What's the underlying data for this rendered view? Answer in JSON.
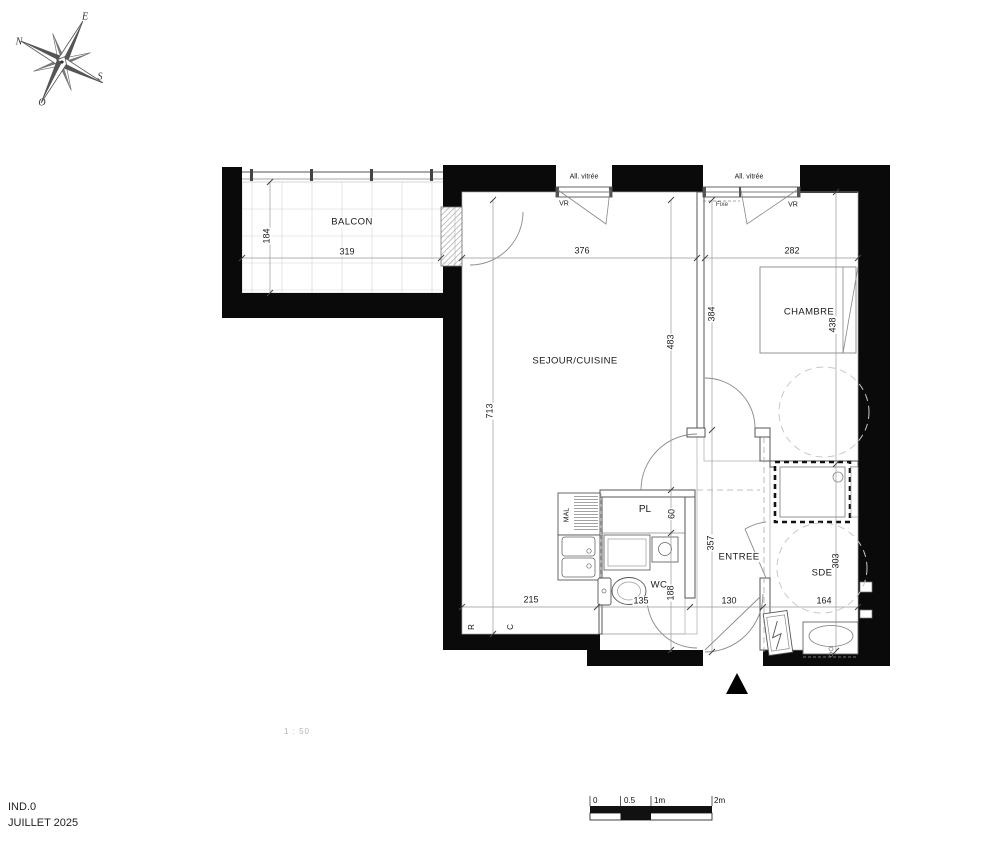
{
  "meta": {
    "revision": "IND.0",
    "date": "JUILLET 2025",
    "scale_note": "1 : 50"
  },
  "compass": {
    "n": "N",
    "e": "E",
    "s": "S",
    "o": "O"
  },
  "scale_bar": {
    "t0": "0",
    "t05": "0.5",
    "t1": "1m",
    "t2": "2m"
  },
  "openings": {
    "w1_label": "All. vitrée",
    "w1_shutter": "VR",
    "w2_label": "All. vitrée",
    "w2_fixed": "Fixe",
    "w2_shutter": "VR"
  },
  "rooms": {
    "balcon": {
      "name": "BALCON",
      "width": "319",
      "depth": "184"
    },
    "sejour": {
      "name": "SEJOUR/CUISINE",
      "width": "376",
      "height": "713",
      "east_height": "483",
      "kitchen_width": "215"
    },
    "chambre": {
      "name": "CHAMBRE",
      "width": "282",
      "west_height": "384",
      "east_height": "438"
    },
    "entree": {
      "name": "ENTREE",
      "height": "357",
      "door_width": "130"
    },
    "wc": {
      "name": "WC",
      "width": "135",
      "depth": "188"
    },
    "pl": {
      "name": "PL",
      "depth": "60"
    },
    "sde": {
      "name": "SDE",
      "width": "164",
      "height": "303"
    }
  },
  "equipment": {
    "washer": "MAL",
    "radiator": "R",
    "convector": "C"
  }
}
